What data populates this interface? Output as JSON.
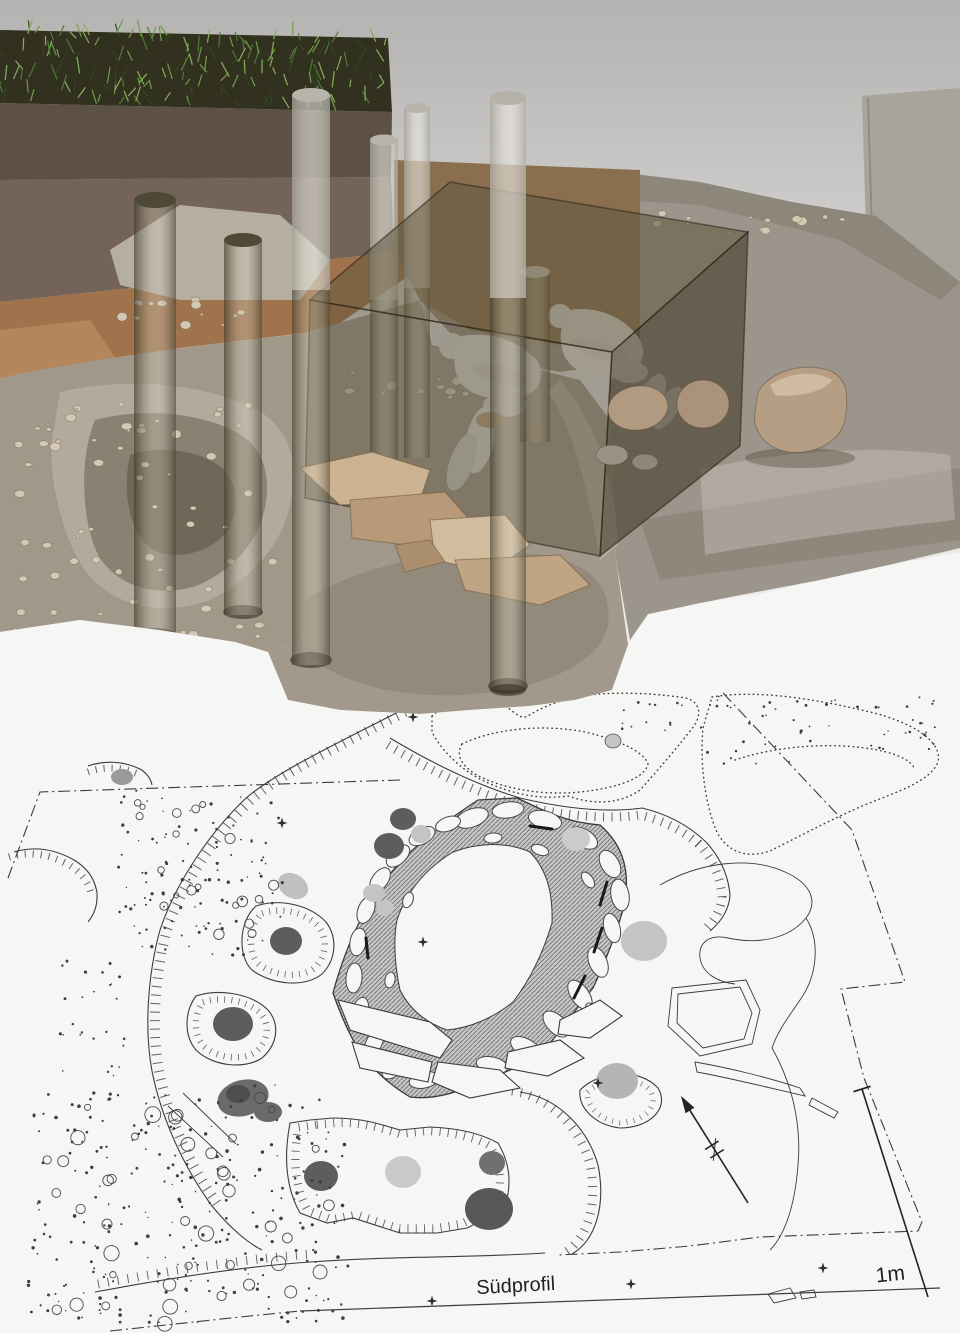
{
  "figure": {
    "type": "archaeological burial reconstruction above excavation plan",
    "colors": {
      "background": "#c6c5c3",
      "paper": "#f6f6f4",
      "ink": "#3c3c3c",
      "grass": "#32301f",
      "topsoil": "#5d5045",
      "topsoil_lower": "#746358",
      "subsoil": "#a0734d",
      "terrain_right": "#9c958b",
      "terrain_left": "#a2988a",
      "pit_wall": "#b3a99d",
      "pit_floor": "#948a7c",
      "back_wall": "#a8a39b",
      "ledge": "#b5aea1",
      "chamber": "#60583e",
      "post": "#7d755c",
      "body": "#d8d6d2",
      "stone_tan": "#c2a988",
      "boulder": "#b29a80",
      "posthole_dark": "#5d5d5d",
      "posthole_light": "#c4c4c4",
      "ring_band": "#c7c7c7",
      "ring_hatch": "#6f6f6f"
    },
    "plan": {
      "profile_label": "Südprofil",
      "scale_label": "1m",
      "survey_points": [
        [
          413,
          717
        ],
        [
          282,
          823
        ],
        [
          423,
          942
        ],
        [
          598,
          1083
        ],
        [
          823,
          1268
        ],
        [
          631,
          1284
        ],
        [
          432,
          1301
        ]
      ],
      "north_arrow": {
        "tail": [
          748,
          1203
        ],
        "tip": [
          681,
          1096
        ]
      },
      "scale_bar": {
        "top": [
          862,
          1089
        ],
        "bottom": [
          928,
          1297
        ]
      }
    },
    "stipple_clusters": [
      {
        "x": 118,
        "y": 788,
        "w": 165,
        "h": 168,
        "n": 110,
        "rmin": 0.7,
        "rmax": 1.7,
        "kind": "dot"
      },
      {
        "x": 125,
        "y": 798,
        "w": 150,
        "h": 150,
        "n": 20,
        "rmin": 2.5,
        "rmax": 5.5,
        "kind": "ring"
      },
      {
        "x": 28,
        "y": 1085,
        "w": 320,
        "h": 238,
        "n": 260,
        "rmin": 0.7,
        "rmax": 1.8,
        "kind": "dot"
      },
      {
        "x": 40,
        "y": 1095,
        "w": 300,
        "h": 230,
        "n": 42,
        "rmin": 3,
        "rmax": 8,
        "kind": "ring"
      },
      {
        "x": 700,
        "y": 694,
        "w": 235,
        "h": 72,
        "n": 55,
        "rmin": 0.7,
        "rmax": 1.5,
        "kind": "dot"
      },
      {
        "x": 622,
        "y": 700,
        "w": 80,
        "h": 32,
        "n": 14,
        "rmin": 0.7,
        "rmax": 1.4,
        "kind": "dot"
      },
      {
        "x": 55,
        "y": 955,
        "w": 70,
        "h": 125,
        "n": 26,
        "rmin": 0.8,
        "rmax": 1.6,
        "kind": "dot"
      }
    ],
    "pebble_clusters": [
      {
        "x": 10,
        "y": 398,
        "w": 265,
        "h": 240,
        "n": 64
      },
      {
        "x": 118,
        "y": 300,
        "w": 140,
        "h": 26,
        "n": 15
      },
      {
        "x": 332,
        "y": 372,
        "w": 225,
        "h": 28,
        "n": 16
      },
      {
        "x": 648,
        "y": 207,
        "w": 215,
        "h": 26,
        "n": 13
      }
    ],
    "grass": {
      "x0": 0,
      "x1": 390,
      "n": 170
    }
  }
}
